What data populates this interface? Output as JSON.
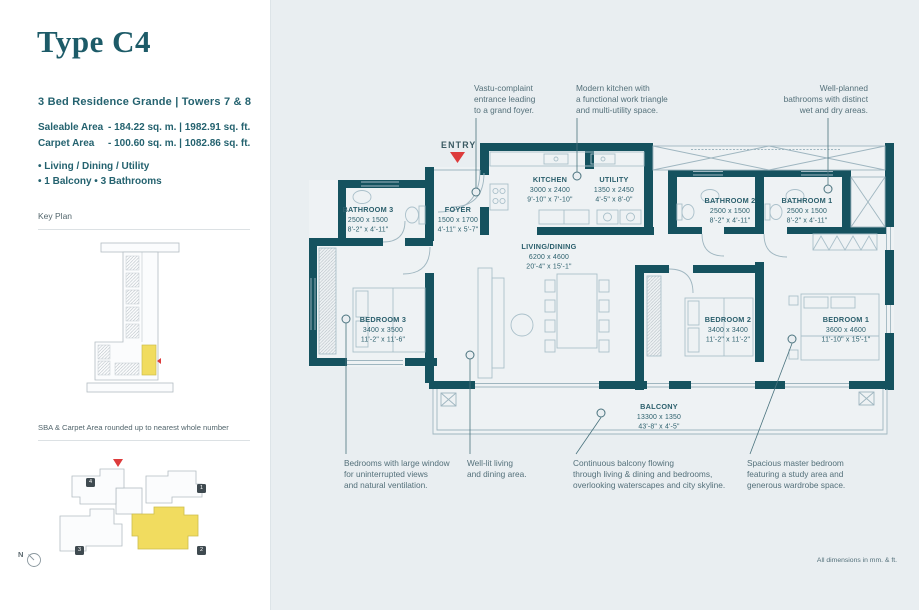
{
  "colors": {
    "wall": "#15525f",
    "panel_bg": "#e9eef1",
    "title_teal": "#1d5b68",
    "text_teal": "#24626f",
    "label": "#2b5f6c",
    "ann": "#54707a",
    "leader": "#4a737e",
    "furn": "#aac0ca",
    "thin": "#9fb6c0",
    "red": "#dd3b3b",
    "yellow": "#f1dc5f",
    "keyline": "#b3bcc2",
    "badge": "#3f4a50"
  },
  "sidebar": {
    "title": "Type C4",
    "subtitle": "3 Bed Residence Grande  |  Towers 7 & 8",
    "areas": [
      {
        "label": "Saleable Area",
        "value": "-  184.22 sq. m.   |   1982.91 sq. ft."
      },
      {
        "label": "Carpet Area",
        "value": "-  100.60 sq. m.   |   1082.86 sq. ft."
      }
    ],
    "features": [
      "•   Living / Dining / Utility",
      "•   1 Balcony    •   3 Bathrooms"
    ],
    "key_plan_label": "Key Plan",
    "note": "SBA & Carpet Area rounded up to nearest whole number",
    "north_label": "N",
    "site_units": [
      "1",
      "2",
      "3",
      "4"
    ]
  },
  "plan": {
    "entry_label": "ENTRY",
    "dimensions_note": "All dimensions in mm. & ft.",
    "rooms": [
      {
        "id": "bathroom-3",
        "name": "BATHROOM 3",
        "mm": "2500 x 1500",
        "ft": "8'-2\" x 4'-11\"",
        "x": 367,
        "y": 212
      },
      {
        "id": "foyer",
        "name": "FOYER",
        "mm": "1500 x 1700",
        "ft": "4'-11\" x 5'-7\"",
        "x": 457,
        "y": 212
      },
      {
        "id": "kitchen",
        "name": "KITCHEN",
        "mm": "3000 x 2400",
        "ft": "9'-10\" x 7'-10\"",
        "x": 549,
        "y": 182
      },
      {
        "id": "utility",
        "name": "UTILITY",
        "mm": "1350 x 2450",
        "ft": "4'-5\" x 8'-0\"",
        "x": 613,
        "y": 182
      },
      {
        "id": "living-dining",
        "name": "LIVING/DINING",
        "mm": "6200 x 4600",
        "ft": "20'-4\" x 15'-1\"",
        "x": 548,
        "y": 249
      },
      {
        "id": "bathroom-2",
        "name": "BATHROOM 2",
        "mm": "2500 x 1500",
        "ft": "8'-2\" x 4'-11\"",
        "x": 729,
        "y": 203
      },
      {
        "id": "bathroom-1",
        "name": "BATHROOM 1",
        "mm": "2500 x 1500",
        "ft": "8'-2\" x 4'-11\"",
        "x": 806,
        "y": 203
      },
      {
        "id": "bedroom-3",
        "name": "BEDROOM 3",
        "mm": "3400 x 3500",
        "ft": "11'-2\" x 11'-6\"",
        "x": 382,
        "y": 322
      },
      {
        "id": "bedroom-2",
        "name": "BEDROOM 2",
        "mm": "3400 x 3400",
        "ft": "11'-2\" x 11'-2\"",
        "x": 727,
        "y": 322
      },
      {
        "id": "bedroom-1",
        "name": "BEDROOM 1",
        "mm": "3600 x 4600",
        "ft": "11'-10\" x 15'-1\"",
        "x": 845,
        "y": 322
      },
      {
        "id": "balcony",
        "name": "BALCONY",
        "mm": "13300 x 1350",
        "ft": "43'-8\" x 4'-5\"",
        "x": 658,
        "y": 409
      }
    ],
    "annotations_top": [
      {
        "lines": [
          "Vastu-complaint",
          "entrance leading",
          "to a grand foyer."
        ],
        "x": 473,
        "align": "start",
        "line": [
          475,
          118,
          475,
          187.5
        ],
        "dot": [
          475,
          192
        ]
      },
      {
        "lines": [
          "Modern kitchen with",
          "a functional work triangle",
          "and multi-utility space."
        ],
        "x": 575,
        "align": "start",
        "line": [
          576,
          118,
          576,
          171.5
        ],
        "dot": [
          576,
          176
        ]
      },
      {
        "lines": [
          "Well-planned",
          "bathrooms with distinct",
          "wet and dry areas."
        ],
        "x": 867,
        "align": "end",
        "line": [
          827,
          118,
          827,
          184.5
        ],
        "dot": [
          827,
          189
        ]
      }
    ],
    "annotations_bottom": [
      {
        "lines": [
          "Bedrooms with large window",
          "for uninterrupted views",
          "and natural ventilation."
        ],
        "x": 343,
        "align": "start",
        "line": [
          345,
          323.5,
          345,
          454
        ],
        "dot": [
          345,
          319
        ]
      },
      {
        "lines": [
          "Well-lit living",
          "and dining area."
        ],
        "x": 466,
        "align": "start",
        "line": [
          469,
          359.5,
          469,
          454
        ],
        "dot": [
          469,
          355
        ]
      },
      {
        "lines": [
          "Continuous balcony flowing",
          "through living & dining and bedrooms,",
          "overlooking waterscapes and city skyline."
        ],
        "x": 572,
        "align": "start",
        "line": [
          600,
          417.5,
          575,
          454
        ],
        "dot": [
          600,
          413
        ]
      },
      {
        "lines": [
          "Spacious master bedroom",
          "featuring a study area and",
          "generous wardrobe space."
        ],
        "x": 746,
        "align": "start",
        "line": [
          791,
          343.5,
          749,
          454
        ],
        "dot": [
          791,
          339
        ]
      }
    ]
  }
}
